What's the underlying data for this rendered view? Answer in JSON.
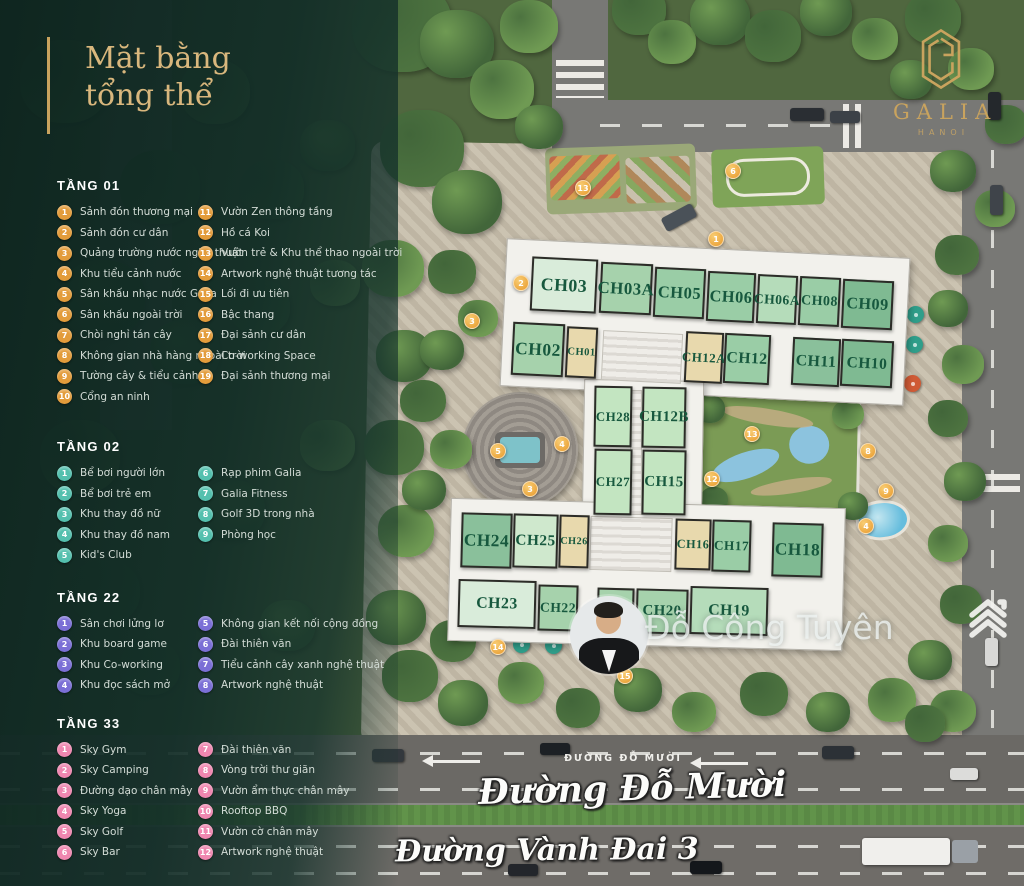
{
  "title": {
    "line1": "Mặt bằng",
    "line2": "tổng thể"
  },
  "brand": {
    "name": "GALIA",
    "city": "HANOI"
  },
  "watermark": {
    "name": "Đỗ Công Tuyên"
  },
  "roads": {
    "label_small": "ĐƯỜNG ĐỖ MƯỜI",
    "label_do_muoi": "Đường Đỗ Mười",
    "label_vanh_dai": "Đường Vành Đai 3"
  },
  "legend_sections": [
    {
      "name": "TẦNG 01",
      "color": "#e39c3b",
      "split": 10,
      "items": [
        {
          "n": "1",
          "label": "Sảnh đón thương mại"
        },
        {
          "n": "2",
          "label": "Sảnh đón cư dân"
        },
        {
          "n": "3",
          "label": "Quảng trường nước nghệ thuật"
        },
        {
          "n": "4",
          "label": "Khu tiểu cảnh nước"
        },
        {
          "n": "5",
          "label": "Sân khấu nhạc nước Galia"
        },
        {
          "n": "6",
          "label": "Sân khấu ngoài trời"
        },
        {
          "n": "7",
          "label": "Chòi nghỉ tán cây"
        },
        {
          "n": "8",
          "label": "Không gian nhà hàng ngoài trời"
        },
        {
          "n": "9",
          "label": "Tường cây & tiểu cảnh"
        },
        {
          "n": "10",
          "label": "Cổng an ninh"
        },
        {
          "n": "11",
          "label": "Vườn Zen thông tầng"
        },
        {
          "n": "12",
          "label": "Hồ cá Koi"
        },
        {
          "n": "13",
          "label": "Vườn trẻ & Khu thể thao ngoài trời"
        },
        {
          "n": "14",
          "label": "Artwork nghệ thuật tương tác"
        },
        {
          "n": "15",
          "label": "Lối đi ưu tiên"
        },
        {
          "n": "16",
          "label": "Bậc thang"
        },
        {
          "n": "17",
          "label": "Đại sảnh cư dân"
        },
        {
          "n": "18",
          "label": "Co-working Space"
        },
        {
          "n": "19",
          "label": "Đại sảnh thương mại"
        }
      ]
    },
    {
      "name": "TẦNG 02",
      "color": "#54c0ae",
      "split": 5,
      "items": [
        {
          "n": "1",
          "label": "Bể bơi người lớn"
        },
        {
          "n": "2",
          "label": "Bể bơi trẻ em"
        },
        {
          "n": "3",
          "label": "Khu thay đồ nữ"
        },
        {
          "n": "4",
          "label": "Khu thay đồ nam"
        },
        {
          "n": "5",
          "label": "Kid's Club"
        },
        {
          "n": "6",
          "label": "Rạp phim Galia"
        },
        {
          "n": "7",
          "label": "Galia Fitness"
        },
        {
          "n": "8",
          "label": "Golf 3D trong nhà"
        },
        {
          "n": "9",
          "label": "Phòng học"
        }
      ]
    },
    {
      "name": "TẦNG 22",
      "color": "#7b6fd6",
      "split": 4,
      "items": [
        {
          "n": "1",
          "label": "Sân chơi lửng lơ"
        },
        {
          "n": "2",
          "label": "Khu board game"
        },
        {
          "n": "3",
          "label": "Khu Co-working"
        },
        {
          "n": "4",
          "label": "Khu đọc sách mở"
        },
        {
          "n": "5",
          "label": "Không gian kết nối cộng đồng"
        },
        {
          "n": "6",
          "label": "Đài thiên văn"
        },
        {
          "n": "7",
          "label": "Tiểu cảnh cây xanh nghệ thuật"
        },
        {
          "n": "8",
          "label": "Artwork nghệ thuật"
        }
      ]
    },
    {
      "name": "TẦNG 33",
      "color": "#ef87b0",
      "split": 6,
      "items": [
        {
          "n": "1",
          "label": "Sky Gym"
        },
        {
          "n": "2",
          "label": "Sky Camping"
        },
        {
          "n": "3",
          "label": "Đường dạo chân mây"
        },
        {
          "n": "4",
          "label": "Sky Yoga"
        },
        {
          "n": "5",
          "label": "Sky Golf"
        },
        {
          "n": "6",
          "label": "Sky Bar"
        },
        {
          "n": "7",
          "label": "Đài thiên văn"
        },
        {
          "n": "8",
          "label": "Vòng trời thư giãn"
        },
        {
          "n": "9",
          "label": "Vườn ẩm thực chân mây"
        },
        {
          "n": "10",
          "label": "Rooftop BBQ"
        },
        {
          "n": "11",
          "label": "Vườn cờ chân mây"
        },
        {
          "n": "12",
          "label": "Artwork nghệ thuật"
        }
      ]
    }
  ],
  "units": [
    {
      "id": "CH03",
      "x": 531,
      "y": 258,
      "w": 66,
      "h": 54,
      "bg": "#d9ecda",
      "rot": 2.8
    },
    {
      "id": "CH03A",
      "x": 600,
      "y": 263,
      "w": 52,
      "h": 51,
      "bg": "#a6d2ac",
      "rot": 2.8
    },
    {
      "id": "CH05",
      "x": 654,
      "y": 268,
      "w": 51,
      "h": 50,
      "bg": "#9acda6",
      "rot": 2.8
    },
    {
      "id": "CH06",
      "x": 707,
      "y": 272,
      "w": 48,
      "h": 50,
      "bg": "#9acda6",
      "rot": 2.8
    },
    {
      "id": "CH06A",
      "x": 757,
      "y": 275,
      "w": 40,
      "h": 49,
      "bg": "#b5dcba",
      "rot": 2.8
    },
    {
      "id": "CH08",
      "x": 799,
      "y": 277,
      "w": 41,
      "h": 49,
      "bg": "#9acda6",
      "rot": 2.8
    },
    {
      "id": "CH09",
      "x": 842,
      "y": 280,
      "w": 51,
      "h": 49,
      "bg": "#7fba92",
      "rot": 2.8
    },
    {
      "id": "CH02",
      "x": 512,
      "y": 323,
      "w": 52,
      "h": 53,
      "bg": "#a6d2ac",
      "rot": 2.8
    },
    {
      "id": "CH01",
      "x": 566,
      "y": 327,
      "w": 31,
      "h": 51,
      "bg": "#e8d9ad",
      "rot": 2.8
    },
    {
      "id": "CH12A",
      "x": 685,
      "y": 332,
      "w": 38,
      "h": 51,
      "bg": "#e8d9ad",
      "rot": 2.8
    },
    {
      "id": "CH12",
      "x": 724,
      "y": 334,
      "w": 46,
      "h": 50,
      "bg": "#9acda6",
      "rot": 2.8
    },
    {
      "id": "CH11",
      "x": 792,
      "y": 338,
      "w": 48,
      "h": 48,
      "bg": "#8ac09b",
      "rot": 2.8
    },
    {
      "id": "CH10",
      "x": 841,
      "y": 340,
      "w": 52,
      "h": 47,
      "bg": "#7fba92",
      "rot": 2.8
    },
    {
      "id": "CH28",
      "x": 594,
      "y": 386,
      "w": 38,
      "h": 61,
      "bg": "#c3e5c1",
      "rot": 1
    },
    {
      "id": "CH12B",
      "x": 642,
      "y": 387,
      "w": 44,
      "h": 61,
      "bg": "#c3e5c1",
      "rot": 1
    },
    {
      "id": "CH27",
      "x": 594,
      "y": 449,
      "w": 38,
      "h": 66,
      "bg": "#c3e5c1",
      "rot": 1
    },
    {
      "id": "CH15",
      "x": 642,
      "y": 450,
      "w": 44,
      "h": 65,
      "bg": "#c3e5c1",
      "rot": 1
    },
    {
      "id": "CH24",
      "x": 461,
      "y": 513,
      "w": 51,
      "h": 55,
      "bg": "#8ac09b",
      "rot": 1.5
    },
    {
      "id": "CH25",
      "x": 513,
      "y": 514,
      "w": 45,
      "h": 54,
      "bg": "#cfe8cd",
      "rot": 1.5
    },
    {
      "id": "CH26",
      "x": 559,
      "y": 515,
      "w": 30,
      "h": 53,
      "bg": "#e8d9ad",
      "rot": 1.5
    },
    {
      "id": "CH16",
      "x": 675,
      "y": 519,
      "w": 36,
      "h": 51,
      "bg": "#e8d9ad",
      "rot": 1.5
    },
    {
      "id": "CH17",
      "x": 712,
      "y": 520,
      "w": 39,
      "h": 52,
      "bg": "#9acda6",
      "rot": 1.5
    },
    {
      "id": "CH18",
      "x": 772,
      "y": 523,
      "w": 51,
      "h": 54,
      "bg": "#7fba92",
      "rot": 1.5
    },
    {
      "id": "CH23",
      "x": 458,
      "y": 580,
      "w": 78,
      "h": 48,
      "bg": "#d9ecda",
      "rot": 1.5
    },
    {
      "id": "CH22",
      "x": 538,
      "y": 585,
      "w": 40,
      "h": 46,
      "bg": "#a6d2ac",
      "rot": 1.5
    },
    {
      "id": "CH21",
      "x": 597,
      "y": 588,
      "w": 37,
      "h": 45,
      "bg": "#a6d2ac",
      "rot": 1.5
    },
    {
      "id": "CH20",
      "x": 636,
      "y": 589,
      "w": 52,
      "h": 45,
      "bg": "#a6d2ac",
      "rot": 1.5
    },
    {
      "id": "CH19",
      "x": 690,
      "y": 587,
      "w": 78,
      "h": 48,
      "bg": "#b5dcba",
      "rot": 1.5
    }
  ],
  "map_markers": [
    {
      "x": 521,
      "y": 283,
      "n": "2"
    },
    {
      "x": 472,
      "y": 321,
      "n": "3"
    },
    {
      "x": 583,
      "y": 188,
      "n": "13"
    },
    {
      "x": 733,
      "y": 171,
      "n": "6"
    },
    {
      "x": 716,
      "y": 239,
      "n": "1"
    },
    {
      "x": 498,
      "y": 451,
      "n": "5"
    },
    {
      "x": 562,
      "y": 444,
      "n": "4"
    },
    {
      "x": 530,
      "y": 489,
      "n": "3"
    },
    {
      "x": 712,
      "y": 479,
      "n": "12"
    },
    {
      "x": 752,
      "y": 434,
      "n": "13"
    },
    {
      "x": 868,
      "y": 451,
      "n": "8"
    },
    {
      "x": 886,
      "y": 491,
      "n": "9"
    },
    {
      "x": 866,
      "y": 526,
      "n": "4"
    },
    {
      "x": 498,
      "y": 647,
      "n": "14"
    },
    {
      "x": 625,
      "y": 676,
      "n": "15"
    }
  ]
}
